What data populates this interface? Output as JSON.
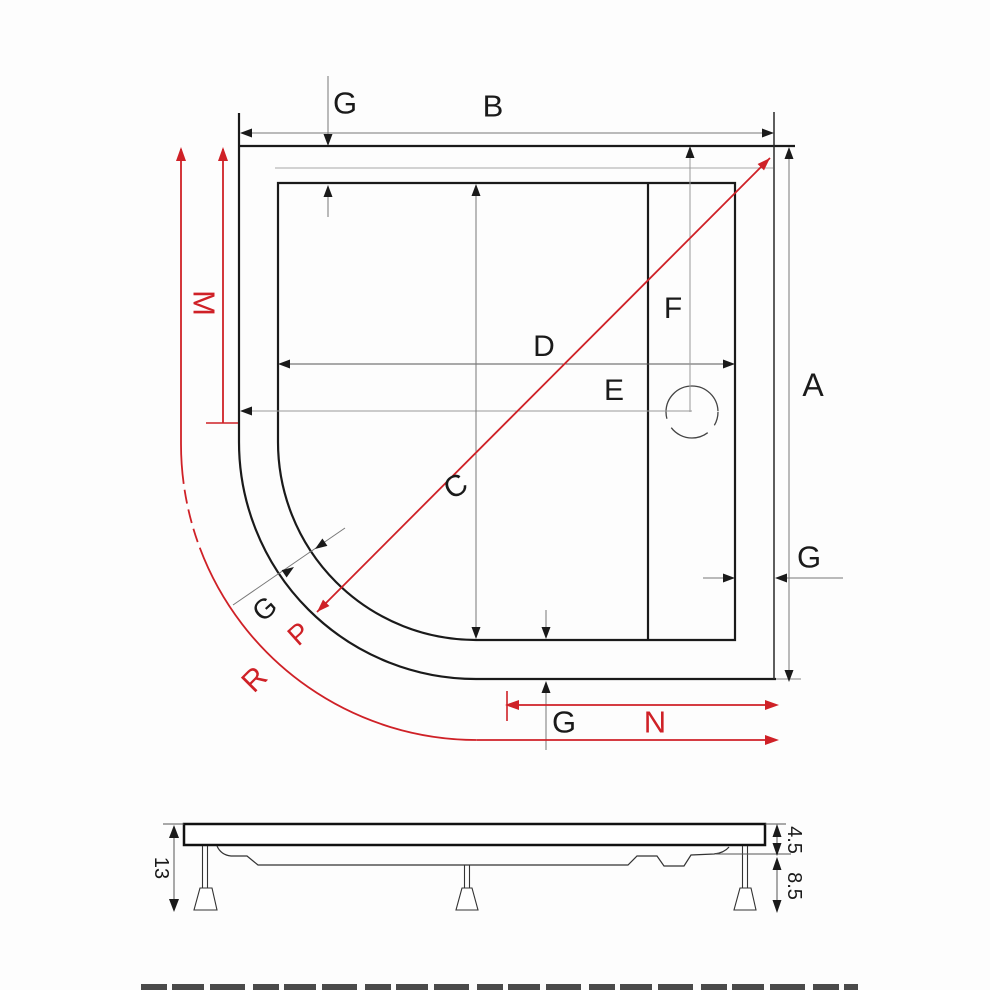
{
  "top_view": {
    "labels": {
      "g_top": "G",
      "b": "B",
      "a": "A",
      "f": "F",
      "d": "D",
      "e": "E",
      "c": "C",
      "m": "M",
      "g_right": "G",
      "g_corner": "G",
      "p": "P",
      "r": "R",
      "g_bottom": "G",
      "n": "N"
    }
  },
  "side_view": {
    "labels": {
      "total_height": "13",
      "tray_edge_height": "4.5",
      "leg_height": "8.5"
    }
  },
  "colors": {
    "accent_red": "#cf2127",
    "line_black": "#1a1a1a",
    "dim_gray": "#777777"
  }
}
